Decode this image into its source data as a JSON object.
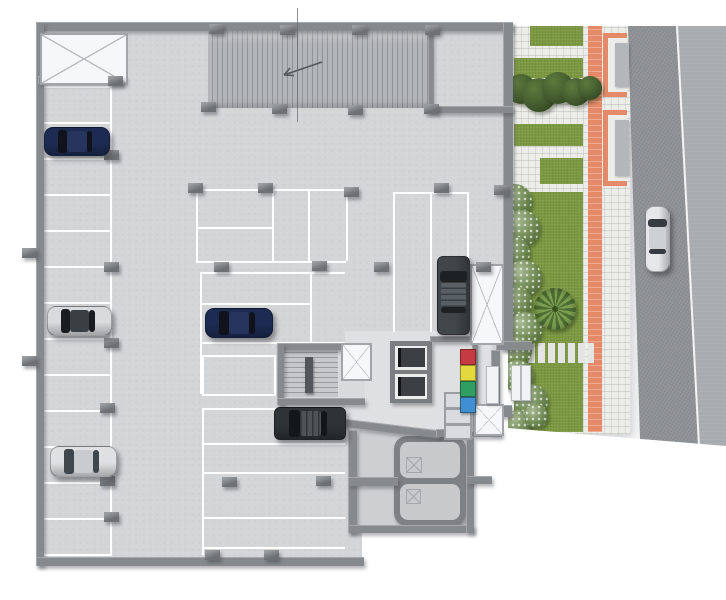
{
  "scene": {
    "title": "Underground parking level - architectural plan render",
    "canvas": {
      "w": 726,
      "h": 600
    },
    "palette": {
      "floor": "#d3d5d7",
      "floor_core": "#dfe0e2",
      "floor_stair": "#d8dadc",
      "floor_tank": "#cdcfd1",
      "wall": "#878a8d",
      "stall_line": "#ffffff",
      "ramp_stripe": "#919497",
      "grass": "#7c9942",
      "bush": "#40582c",
      "paver": "#ecece9",
      "accent_path": "#e58a68",
      "road": "#8f9294",
      "sidewalk": "#a9acae"
    },
    "cars": [
      {
        "id": "car-navy-top-left",
        "type": "sedan",
        "facing": "left",
        "x": 44,
        "y": 127,
        "w": 64,
        "h": 27,
        "body": "#1d2b52",
        "glass": "#10131c",
        "roof": "#27355e"
      },
      {
        "id": "car-silver-left",
        "type": "sedan",
        "facing": "left",
        "x": 47,
        "y": 306,
        "w": 63,
        "h": 28,
        "body": "#d8dadc",
        "glass": "#1a1d20",
        "roof": "#3a3f43"
      },
      {
        "id": "car-white-bottom-left",
        "type": "sedan",
        "facing": "left",
        "x": 50,
        "y": 446,
        "w": 65,
        "h": 29,
        "body": "#dee0e2",
        "glass": "#3f464c",
        "roof": "#c9ccce"
      },
      {
        "id": "car-navy-center",
        "type": "sedan",
        "facing": "left",
        "x": 205,
        "y": 308,
        "w": 66,
        "h": 28,
        "body": "#1d2b52",
        "glass": "#10131c",
        "roof": "#27355e"
      },
      {
        "id": "car-black-suv",
        "type": "suv",
        "facing": "left",
        "x": 274,
        "y": 407,
        "w": 70,
        "h": 31,
        "body": "#2e3336",
        "glass": "#141719",
        "roof": "#4d5357",
        "rack": true
      },
      {
        "id": "car-gray-suv",
        "type": "suv",
        "facing": "up",
        "x": 437,
        "y": 256,
        "w": 31,
        "h": 77,
        "body": "#41464a",
        "glass": "#1d2124",
        "roof": "#596065",
        "rack": true
      },
      {
        "id": "car-white-road",
        "type": "sedan",
        "facing": "up",
        "x": 645,
        "y": 206,
        "w": 23,
        "h": 64,
        "body": "#e5e7e9",
        "glass": "#363b40",
        "roof": "#ced1d3"
      }
    ],
    "recycling_bins": [
      {
        "color_name": "red",
        "hex": "#c63b42"
      },
      {
        "color_name": "yellow",
        "hex": "#e3d83e"
      },
      {
        "color_name": "green",
        "hex": "#2f9e63"
      },
      {
        "color_name": "blue",
        "hex": "#3f8fd2"
      }
    ],
    "bins_layout": {
      "x": 460,
      "y0": 349,
      "size": 14,
      "gap": 2
    },
    "left_stalls": {
      "x": 40,
      "y0": 86,
      "spacing": 36,
      "count": 14,
      "width": 70,
      "vline_x": 110,
      "vline_y0": 86,
      "vline_h": 470
    },
    "lines_h": [
      [
        196,
        189,
        150
      ],
      [
        196,
        227,
        76
      ],
      [
        196,
        261,
        150
      ],
      [
        393,
        192,
        76
      ],
      [
        200,
        272,
        145
      ],
      [
        200,
        303,
        112
      ],
      [
        200,
        342,
        145
      ],
      [
        202,
        408,
        143
      ],
      [
        202,
        443,
        143
      ],
      [
        202,
        472,
        143
      ],
      [
        202,
        517,
        143
      ],
      [
        202,
        547,
        143
      ]
    ],
    "lines_v": [
      [
        196,
        189,
        72
      ],
      [
        272,
        189,
        72
      ],
      [
        308,
        189,
        72
      ],
      [
        346,
        189,
        72
      ],
      [
        393,
        192,
        140
      ],
      [
        430,
        192,
        140
      ],
      [
        467,
        192,
        70
      ],
      [
        200,
        272,
        122
      ],
      [
        310,
        272,
        70
      ],
      [
        202,
        408,
        147
      ]
    ],
    "stall_boxes": [
      {
        "x": 202,
        "y": 355,
        "w": 70,
        "h": 37
      }
    ],
    "x_boxes": [
      {
        "x": 40,
        "y": 33,
        "w": 84,
        "h": 48
      },
      {
        "x": 470,
        "y": 264,
        "w": 30,
        "h": 77
      },
      {
        "x": 341,
        "y": 343,
        "w": 27,
        "h": 34
      },
      {
        "x": 474,
        "y": 404,
        "w": 26,
        "h": 28
      }
    ],
    "tank_glyphs": [
      [
        406,
        457,
        14,
        14
      ],
      [
        406,
        489,
        13,
        13
      ]
    ],
    "walls": [
      [
        36,
        22,
        477,
        9
      ],
      [
        36,
        22,
        8,
        544
      ],
      [
        36,
        557,
        328,
        9
      ],
      [
        503,
        22,
        10,
        328
      ],
      [
        496,
        341,
        36,
        9
      ],
      [
        491,
        350,
        9,
        84
      ],
      [
        436,
        429,
        66,
        8
      ],
      [
        348,
        430,
        9,
        103
      ],
      [
        348,
        525,
        126,
        8
      ],
      [
        466,
        437,
        8,
        96
      ],
      [
        348,
        477,
        50,
        9
      ],
      [
        466,
        476,
        26,
        8
      ],
      [
        277,
        343,
        68,
        7
      ],
      [
        277,
        343,
        7,
        62
      ],
      [
        277,
        398,
        88,
        7
      ],
      [
        428,
        28,
        5,
        82
      ],
      [
        428,
        106,
        85,
        7
      ],
      [
        38,
        76,
        88,
        8
      ],
      [
        472,
        340,
        6,
        92
      ],
      [
        430,
        336,
        44,
        6
      ],
      [
        492,
        405,
        20,
        12
      ]
    ],
    "columns": [
      [
        201,
        102
      ],
      [
        272,
        104
      ],
      [
        348,
        105
      ],
      [
        424,
        104
      ],
      [
        209,
        24
      ],
      [
        280,
        25
      ],
      [
        352,
        25
      ],
      [
        425,
        25
      ],
      [
        108,
        76
      ],
      [
        104,
        150
      ],
      [
        104,
        262
      ],
      [
        104,
        338
      ],
      [
        100,
        403
      ],
      [
        100,
        476
      ],
      [
        104,
        512
      ],
      [
        22,
        248
      ],
      [
        22,
        356
      ],
      [
        188,
        183
      ],
      [
        258,
        183
      ],
      [
        344,
        187
      ],
      [
        434,
        183
      ],
      [
        494,
        185
      ],
      [
        214,
        262
      ],
      [
        312,
        261
      ],
      [
        374,
        262
      ],
      [
        476,
        262
      ],
      [
        222,
        477
      ],
      [
        316,
        476
      ],
      [
        205,
        550
      ],
      [
        264,
        550
      ]
    ],
    "cells": [
      [
        444,
        392,
        24,
        13
      ],
      [
        444,
        408,
        24,
        13
      ],
      [
        444,
        424,
        24,
        12
      ]
    ],
    "panels": [
      [
        486,
        366,
        11,
        36
      ],
      [
        511,
        365,
        8,
        34
      ],
      [
        521,
        365,
        8,
        34
      ]
    ],
    "landscape": {
      "origin": {
        "x": 508,
        "y": 24,
        "w": 218,
        "h": 424
      },
      "base": [
        6,
        2,
        116,
        408
      ],
      "walkway": [
        75,
        0,
        47,
        410
      ],
      "orange_stripe": [
        80,
        2,
        14,
        406
      ],
      "grass_bands": [
        [
          22,
          2,
          53,
          20
        ],
        [
          6,
          34,
          69,
          20
        ],
        [
          6,
          100,
          69,
          22
        ],
        [
          32,
          134,
          43,
          26
        ],
        [
          6,
          168,
          69,
          240
        ]
      ],
      "bushes_dark": [
        [
          -2,
          50,
          30
        ],
        [
          14,
          54,
          34
        ],
        [
          34,
          48,
          32
        ],
        [
          54,
          54,
          28
        ],
        [
          70,
          52,
          24
        ]
      ],
      "bushes_flower": [
        [
          -10,
          160,
          34
        ],
        [
          -4,
          186,
          36
        ],
        [
          -12,
          212,
          34
        ],
        [
          -2,
          236,
          36
        ],
        [
          -10,
          262,
          34
        ],
        [
          0,
          288,
          34
        ],
        [
          -6,
          312,
          30
        ],
        [
          -6,
          336,
          32
        ],
        [
          6,
          360,
          34
        ],
        [
          -4,
          386,
          28
        ],
        [
          16,
          380,
          24
        ],
        [
          2,
          406,
          22
        ]
      ],
      "palm": [
        26,
        264,
        42
      ],
      "stones": [
        20,
        319,
        66,
        20
      ],
      "planters": [
        [
          95,
          9,
          24,
          64
        ],
        [
          95,
          86,
          24,
          76
        ]
      ],
      "road_edge": {
        "x": 168,
        "y": 2,
        "h": 419
      }
    }
  }
}
